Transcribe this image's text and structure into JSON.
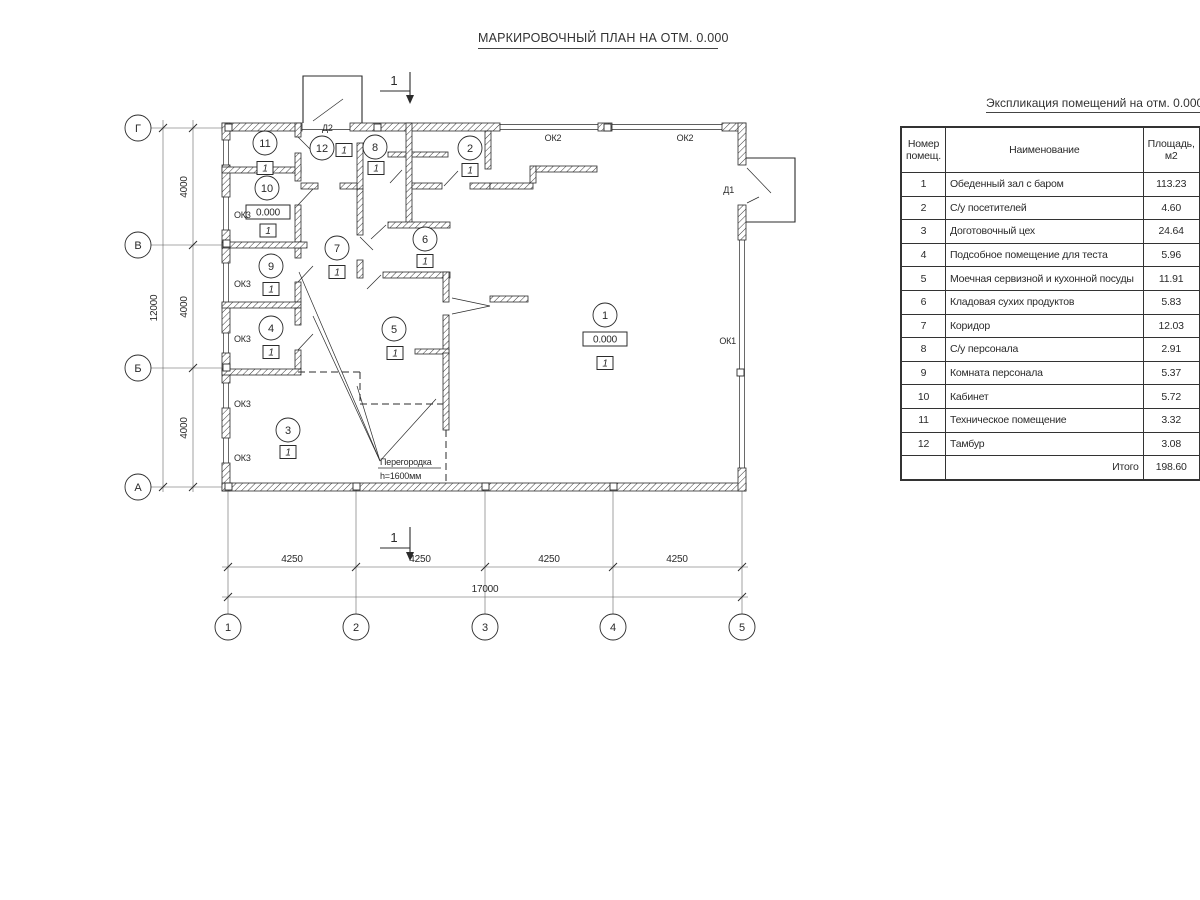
{
  "page_title": "МАРКИРОВОЧНЫЙ ПЛАН НА ОТМ. 0.000",
  "schedule": {
    "title": "Экспликация помещений на отм. 0.000",
    "headers": {
      "num_l1": "Номер",
      "num_l2": "помещ.",
      "name": "Наименование",
      "area_l1": "Площадь,",
      "area_l2": "м2",
      "cut_l1": "Ка",
      "cut_l2": "по"
    },
    "rows": [
      {
        "num": "1",
        "name": "Обеденный зал с баром",
        "area": "113.23"
      },
      {
        "num": "2",
        "name": "С/у посетителей",
        "area": "4.60"
      },
      {
        "num": "3",
        "name": "Доготовочный цех",
        "area": "24.64"
      },
      {
        "num": "4",
        "name": "Подсобное помещение для теста",
        "area": "5.96"
      },
      {
        "num": "5",
        "name": "Моечная сервизной и кухонной посуды",
        "area": "11.91"
      },
      {
        "num": "6",
        "name": "Кладовая сухих продуктов",
        "area": "5.83"
      },
      {
        "num": "7",
        "name": "Коридор",
        "area": "12.03"
      },
      {
        "num": "8",
        "name": "С/у персонала",
        "area": "2.91"
      },
      {
        "num": "9",
        "name": "Комната персонала",
        "area": "5.37"
      },
      {
        "num": "10",
        "name": "Кабинет",
        "area": "5.72"
      },
      {
        "num": "11",
        "name": "Техническое помещение",
        "area": "3.32"
      },
      {
        "num": "12",
        "name": "Тамбур",
        "area": "3.08"
      }
    ],
    "total_label": "Итого",
    "total_area": "198.60"
  },
  "plan": {
    "floor_mark": "1",
    "level_mark": "0.000",
    "section_mark": "1",
    "rooms": [
      {
        "number": "11"
      },
      {
        "number": "12"
      },
      {
        "number": "8"
      },
      {
        "number": "2"
      },
      {
        "number": "10"
      },
      {
        "number": "9"
      },
      {
        "number": "7"
      },
      {
        "number": "6"
      },
      {
        "number": "4"
      },
      {
        "number": "5"
      },
      {
        "number": "3"
      },
      {
        "number": "1"
      }
    ],
    "labels": {
      "ok1": "ОК1",
      "ok2": "ОК2",
      "ok3": "ОК3",
      "d1": "Д1",
      "d2": "Д2",
      "partition_l1": "Перегородка",
      "partition_l2": "h=1600мм"
    }
  },
  "axes": {
    "rows": [
      "Г",
      "В",
      "Б",
      "А"
    ],
    "cols": [
      "1",
      "2",
      "3",
      "4",
      "5"
    ]
  },
  "dimensions": {
    "col_segments": [
      "4250",
      "4250",
      "4250",
      "4250"
    ],
    "col_total": "17000",
    "row_segments": [
      "4000",
      "4000",
      "4000"
    ],
    "row_total": "12000"
  }
}
